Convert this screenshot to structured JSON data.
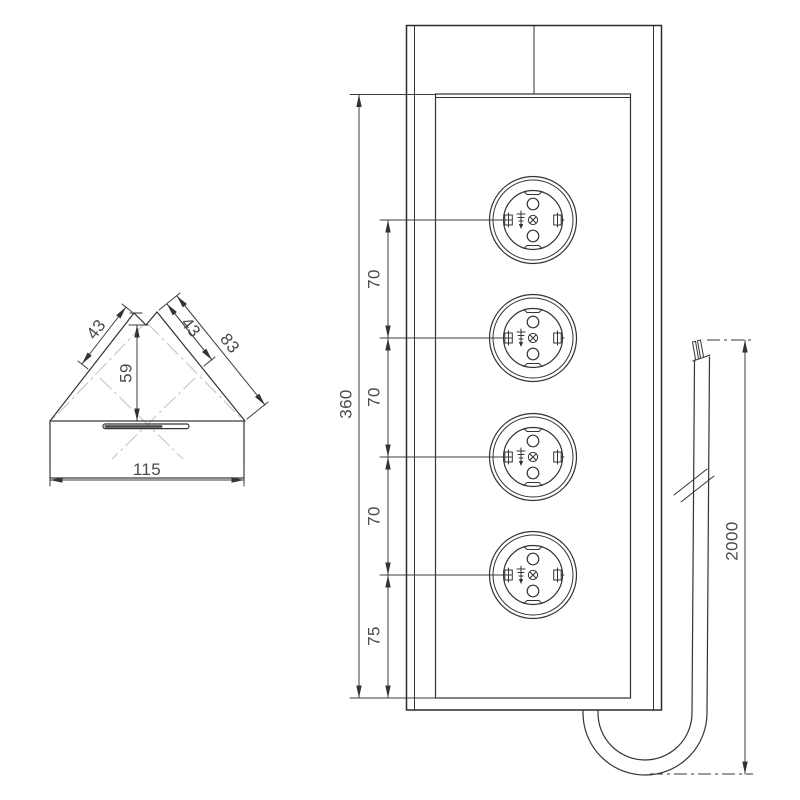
{
  "side_view": {
    "label_left_face_width": "43",
    "label_right_face_width": "43",
    "label_right_edge_length": "83",
    "label_corner_height": "59",
    "label_base_width": "115"
  },
  "front_view": {
    "socket_count": 4,
    "label_total_height": "360",
    "label_spacing_1": "70",
    "label_spacing_2": "70",
    "label_spacing_3": "70",
    "label_bottom_offset": "75"
  },
  "cable": {
    "label_length": "2000"
  },
  "colors": {
    "line": "#333333",
    "dim_text": "#4a4a4a",
    "centerline": "#c6c6c6",
    "background": "#ffffff"
  }
}
